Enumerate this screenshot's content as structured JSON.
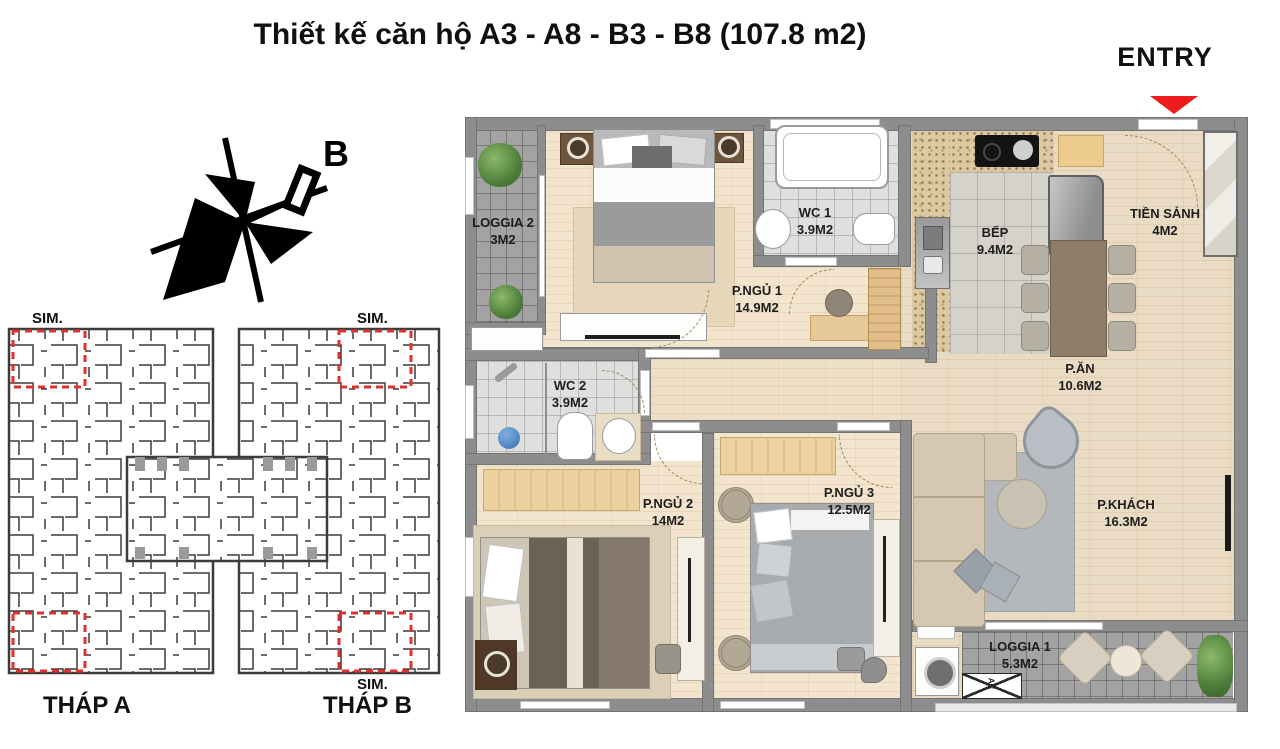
{
  "title": "Thiết kế căn hộ A3 - A8 - B3 - B8 (107.8 m2)",
  "entry": {
    "label": "ENTRY"
  },
  "compass": {
    "label": "B"
  },
  "key_plan": {
    "sim_label": "SIM.",
    "tower_a": "THÁP A",
    "tower_b": "THÁP B"
  },
  "rooms": [
    {
      "id": "loggia-2",
      "name": "LOGGIA 2",
      "area": "3M2"
    },
    {
      "id": "p-ngu-1",
      "name": "P.NGỦ 1",
      "area": "14.9M2"
    },
    {
      "id": "wc-1",
      "name": "WC 1",
      "area": "3.9M2"
    },
    {
      "id": "bep",
      "name": "BẾP",
      "area": "9.4M2"
    },
    {
      "id": "tien-sanh",
      "name": "TIỀN SẢNH",
      "area": "4M2"
    },
    {
      "id": "p-an",
      "name": "P.ĂN",
      "area": "10.6M2"
    },
    {
      "id": "wc-2",
      "name": "WC 2",
      "area": "3.9M2"
    },
    {
      "id": "p-ngu-2",
      "name": "P.NGỦ 2",
      "area": "14M2"
    },
    {
      "id": "p-ngu-3",
      "name": "P.NGỦ 3",
      "area": "12.5M2"
    },
    {
      "id": "p-khach",
      "name": "P.KHÁCH",
      "area": "16.3M2"
    },
    {
      "id": "loggia-1",
      "name": "LOGGIA 1",
      "area": "5.3M2"
    }
  ],
  "ac_label": "AC",
  "colors": {
    "accent_red": "#ee1c1c",
    "sim_box_red": "#e03030",
    "wall_gray": "#8d8d8d",
    "wood_floor": "#eee0c6",
    "loggia_tile": "#a3a3a3"
  }
}
